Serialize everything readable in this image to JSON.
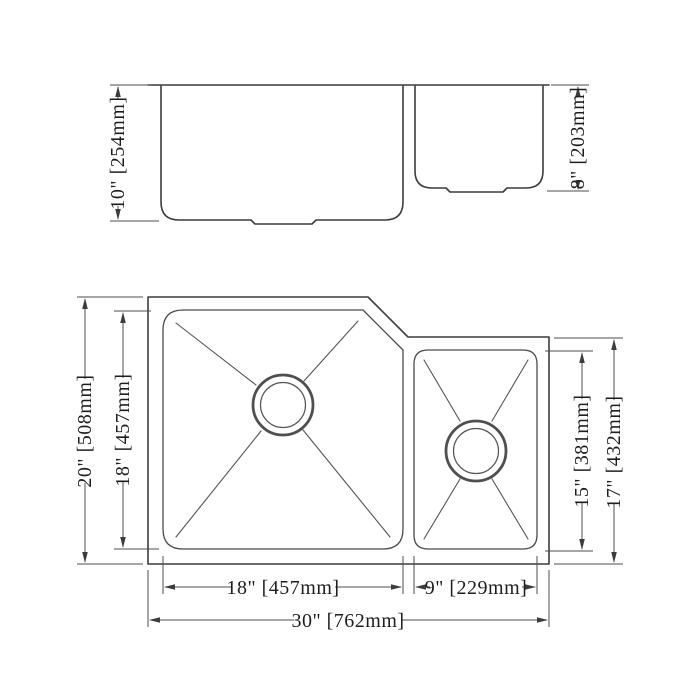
{
  "drawing": {
    "colors": {
      "background": "#ffffff",
      "object_line": "#3c3c3c",
      "dimension_line": "#4d4d4d",
      "text": "#1e1e1e"
    },
    "side_view": {
      "left_bowl_depth": "10\" [254mm]",
      "right_bowl_depth": "8\" [203mm]"
    },
    "plan_view": {
      "overall_front_to_back": "20\" [508mm]",
      "left_bowl_front_to_back": "18\" [457mm]",
      "right_bowl_front_to_back": "15\" [381mm]",
      "right_section_front_to_back": "17\" [432mm]",
      "left_bowl_width": "18\" [457mm]",
      "right_bowl_width": "9\" [229mm]",
      "overall_width": "30\" [762mm]"
    }
  }
}
